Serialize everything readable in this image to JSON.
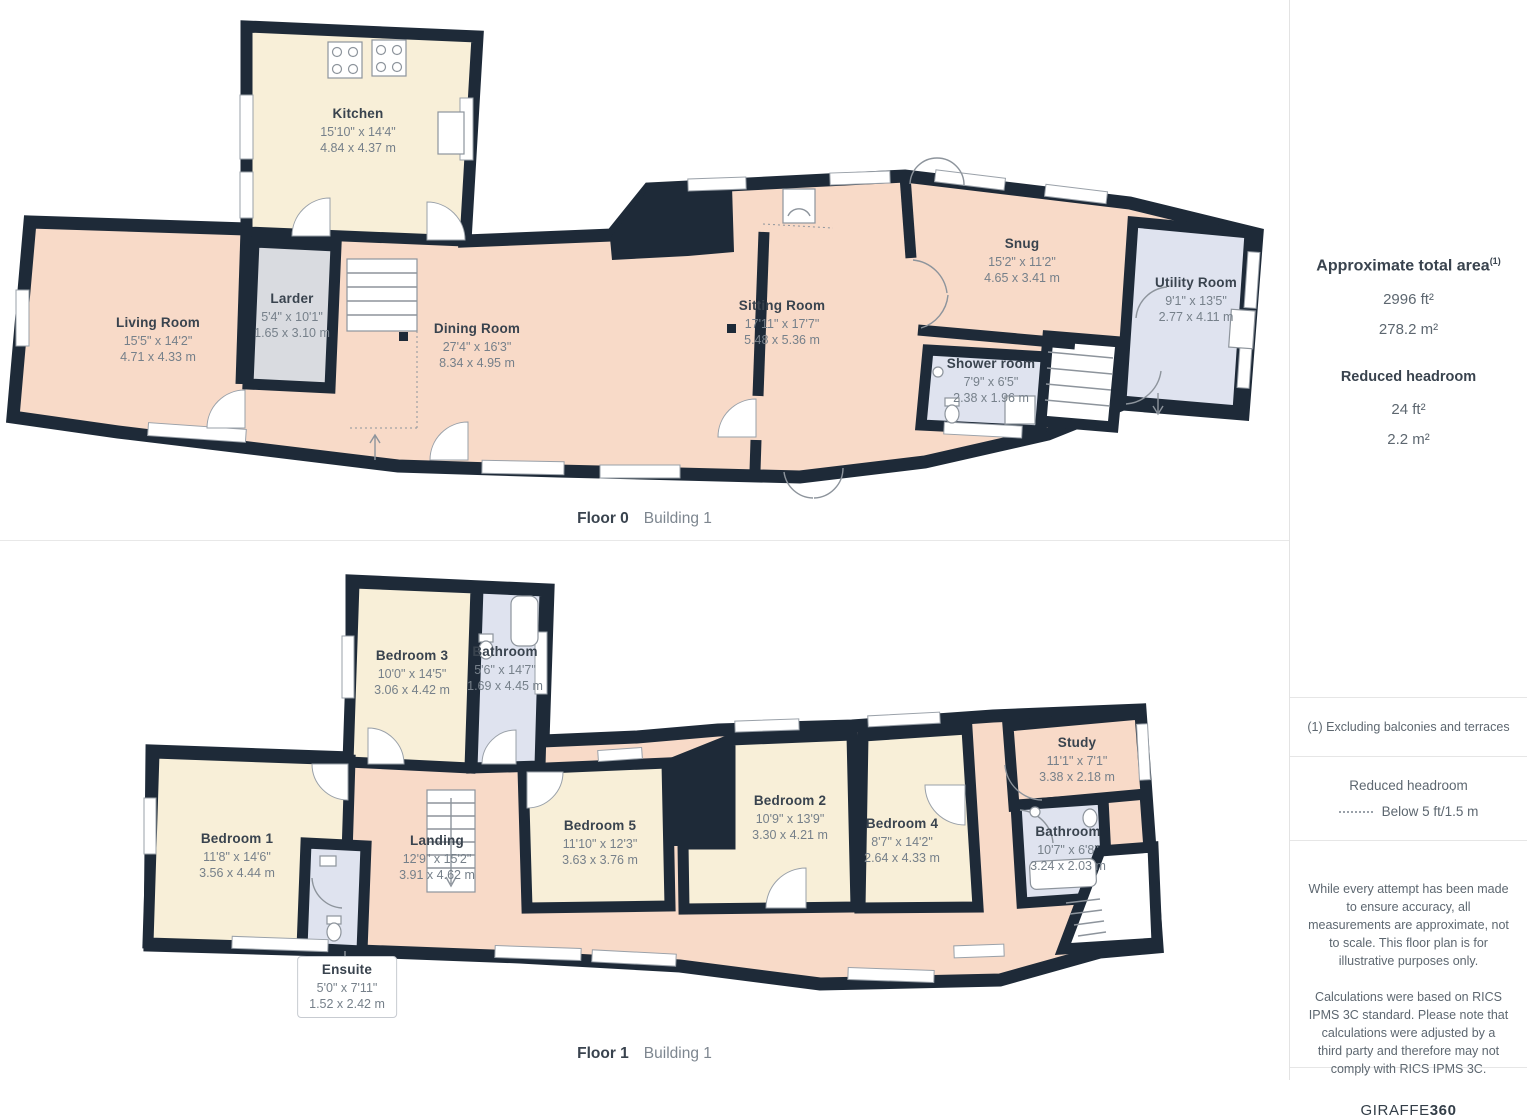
{
  "colors": {
    "wall": "#1e2a38",
    "cream": "#f8efd8",
    "salmon": "#f8dac8",
    "grayroom": "#d9dbe0",
    "blueroom": "#dfe3ef",
    "line": "#8d949c",
    "tdark": "#39434e",
    "tgray": "#76808a"
  },
  "floor0": {
    "caption": {
      "floor": "Floor 0",
      "building": "Building 1"
    },
    "rooms": [
      {
        "name": "Kitchen",
        "imperial": "15'10\" x 14'4\"",
        "metric": "4.84 x 4.37 m"
      },
      {
        "name": "Living Room",
        "imperial": "15'5\" x 14'2\"",
        "metric": "4.71 x 4.33 m"
      },
      {
        "name": "Larder",
        "imperial": "5'4\" x 10'1\"",
        "metric": "1.65 x 3.10 m"
      },
      {
        "name": "Dining Room",
        "imperial": "27'4\" x 16'3\"",
        "metric": "8.34 x 4.95 m"
      },
      {
        "name": "Sitting Room",
        "imperial": "17'11\" x 17'7\"",
        "metric": "5.48 x 5.36 m"
      },
      {
        "name": "Snug",
        "imperial": "15'2\" x 11'2\"",
        "metric": "4.65 x 3.41 m"
      },
      {
        "name": "Shower room",
        "imperial": "7'9\" x 6'5\"",
        "metric": "2.38 x 1.96 m"
      },
      {
        "name": "Utility Room",
        "imperial": "9'1\" x 13'5\"",
        "metric": "2.77 x 4.11 m"
      }
    ]
  },
  "floor1": {
    "caption": {
      "floor": "Floor 1",
      "building": "Building 1"
    },
    "rooms": [
      {
        "name": "Bedroom 3",
        "imperial": "10'0\" x 14'5\"",
        "metric": "3.06 x 4.42 m"
      },
      {
        "name": "Bathroom",
        "imperial": "5'6\" x 14'7\"",
        "metric": "1.69 x 4.45 m"
      },
      {
        "name": "Bedroom 1",
        "imperial": "11'8\" x 14'6\"",
        "metric": "3.56 x 4.44 m"
      },
      {
        "name": "Landing",
        "imperial": "12'9\" x 15'2\"",
        "metric": "3.91 x 4.62 m"
      },
      {
        "name": "Bedroom 5",
        "imperial": "11'10\" x 12'3\"",
        "metric": "3.63 x 3.76 m"
      },
      {
        "name": "Bedroom 2",
        "imperial": "10'9\" x 13'9\"",
        "metric": "3.30 x 4.21 m"
      },
      {
        "name": "Bedroom 4",
        "imperial": "8'7\" x 14'2\"",
        "metric": "2.64 x 4.33 m"
      },
      {
        "name": "Study",
        "imperial": "11'1\" x 7'1\"",
        "metric": "3.38 x 2.18 m"
      },
      {
        "name": "Bathroom",
        "imperial": "10'7\" x 6'8\"",
        "metric": "3.24 x 2.03 m"
      },
      {
        "name": "Ensuite",
        "imperial": "5'0\" x 7'11\"",
        "metric": "1.52 x 2.42 m"
      }
    ]
  },
  "sidebar": {
    "total_area": {
      "title": "Approximate total area",
      "superscript": "(1)",
      "value_ft": "2996 ft²",
      "value_m": "278.2 m²"
    },
    "reduced_headroom": {
      "title": "Reduced headroom",
      "value_ft": "24 ft²",
      "value_m": "2.2 m²"
    },
    "footnote": "(1) Excluding balconies and terraces",
    "legend": {
      "title": "Reduced headroom",
      "label": "Below 5 ft/1.5 m"
    },
    "disclaimer_1": "While every attempt has been made to ensure accuracy, all measurements are approximate, not to scale. This floor plan is for illustrative purposes only.",
    "disclaimer_2": "Calculations were based on RICS IPMS 3C standard. Please note that calculations were adjusted by a third party and therefore may not comply with RICS IPMS 3C.",
    "logo": {
      "brand": "GIRAFFE",
      "suffix": "360"
    }
  }
}
